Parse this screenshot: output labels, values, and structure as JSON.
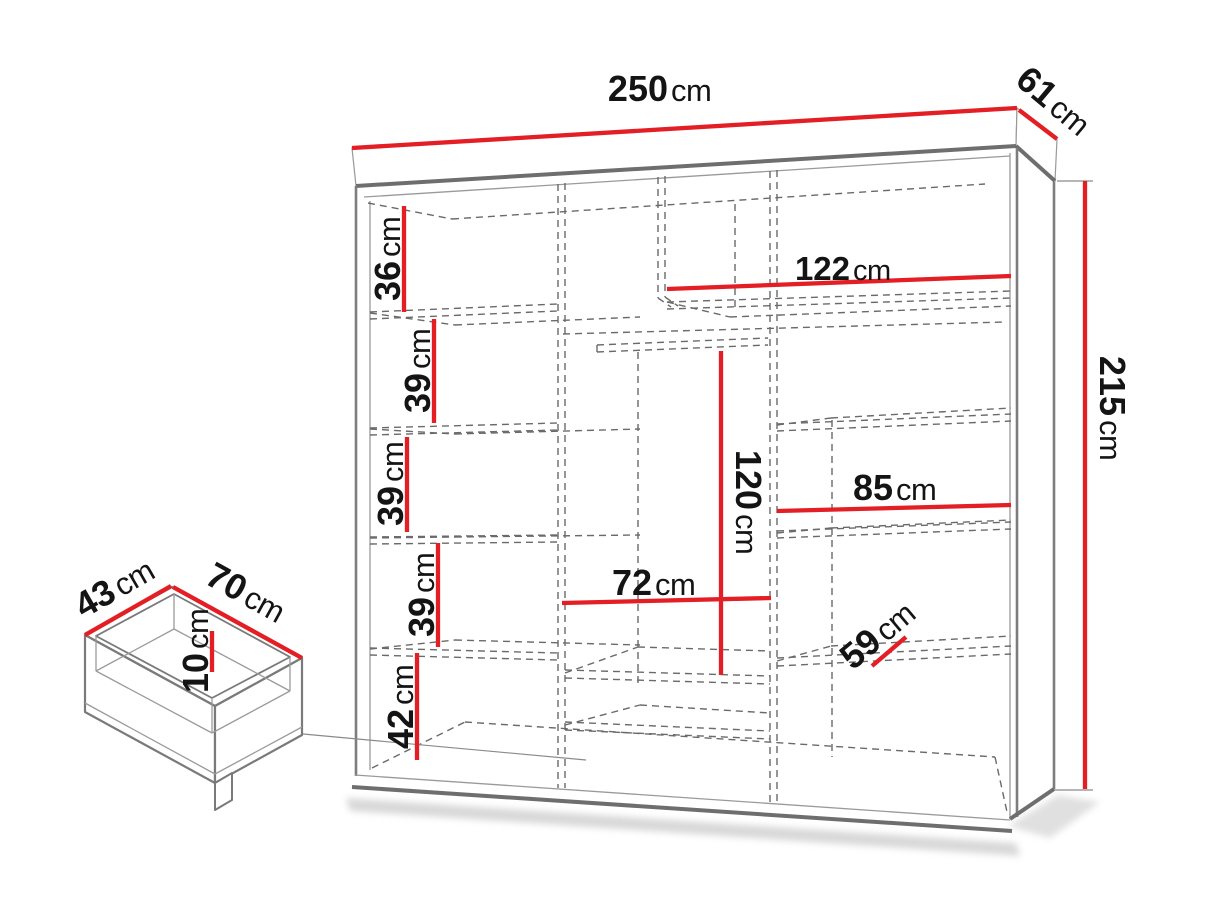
{
  "diagram_title": "Wardrobe dimensions diagram",
  "colors": {
    "dimension_line": "#e31e24",
    "structure_line": "#777777",
    "hidden_line": "#6a6a6a",
    "label_text": "#141414",
    "background": "#ffffff"
  },
  "wardrobe": {
    "width": {
      "value": "250",
      "unit": "cm"
    },
    "depth": {
      "value": "61",
      "unit": "cm"
    },
    "height": {
      "value": "215",
      "unit": "cm"
    },
    "top_shelf_width": {
      "value": "122",
      "unit": "cm"
    },
    "hanging_space_height": {
      "value": "120",
      "unit": "cm"
    },
    "middle_section_width": {
      "value": "72",
      "unit": "cm"
    },
    "right_shelf_width": {
      "value": "85",
      "unit": "cm"
    },
    "shelf_depth": {
      "value": "59",
      "unit": "cm"
    },
    "left_column_shelf_heights": [
      {
        "value": "36",
        "unit": "cm"
      },
      {
        "value": "39",
        "unit": "cm"
      },
      {
        "value": "39",
        "unit": "cm"
      },
      {
        "value": "39",
        "unit": "cm"
      },
      {
        "value": "42",
        "unit": "cm"
      }
    ]
  },
  "drawer": {
    "depth": {
      "value": "43",
      "unit": "cm"
    },
    "width": {
      "value": "70",
      "unit": "cm"
    },
    "height": {
      "value": "10",
      "unit": "cm"
    }
  }
}
